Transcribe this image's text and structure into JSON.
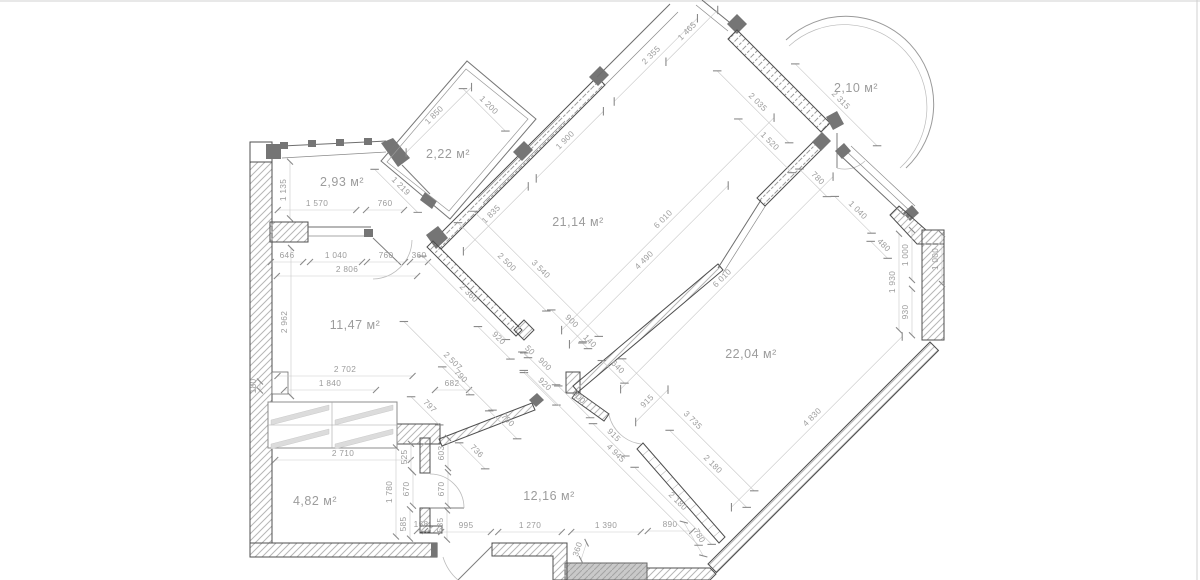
{
  "colors": {
    "background": "#ffffff",
    "wall_stroke": "#4f4f4f",
    "dark_fill": "#757575",
    "dim_text": "#9c9c9c",
    "dim_line": "#c9c9c9",
    "tick": "#8a8a8a",
    "room_text": "#9c9c9c",
    "border": "#d0d0d0"
  },
  "scale_px_per_mm": 0.05,
  "rooms": [
    {
      "label": "2,93 м²",
      "x": 342,
      "y": 186
    },
    {
      "label": "2,22 м²",
      "x": 448,
      "y": 158
    },
    {
      "label": "21,14 м²",
      "x": 578,
      "y": 226
    },
    {
      "label": "2,10 м²",
      "x": 856,
      "y": 92
    },
    {
      "label": "11,47 м²",
      "x": 355,
      "y": 329
    },
    {
      "label": "22,04 м²",
      "x": 751,
      "y": 358
    },
    {
      "label": "4,82 м²",
      "x": 315,
      "y": 505
    },
    {
      "label": "12,16 м²",
      "x": 549,
      "y": 500
    }
  ],
  "dimensions": [
    {
      "t": "1 135",
      "x": 286,
      "y": 190,
      "r": -90
    },
    {
      "t": "1 570",
      "x": 317,
      "y": 206,
      "r": 0
    },
    {
      "t": "760",
      "x": 385,
      "y": 206,
      "r": 0
    },
    {
      "t": "646",
      "x": 287,
      "y": 258,
      "r": 0
    },
    {
      "t": "1 040",
      "x": 336,
      "y": 258,
      "r": 0
    },
    {
      "t": "760",
      "x": 386,
      "y": 258,
      "r": 0
    },
    {
      "t": "360",
      "x": 419,
      "y": 258,
      "r": 0
    },
    {
      "t": "2 806",
      "x": 347,
      "y": 272,
      "r": 0
    },
    {
      "t": "2 962",
      "x": 287,
      "y": 322,
      "r": -90
    },
    {
      "t": "180",
      "x": 256,
      "y": 386,
      "r": -90
    },
    {
      "t": "2 702",
      "x": 345,
      "y": 372,
      "r": 0
    },
    {
      "t": "1 840",
      "x": 330,
      "y": 386,
      "r": 0
    },
    {
      "t": "682",
      "x": 452,
      "y": 386,
      "r": 0
    },
    {
      "t": "2 710",
      "x": 343,
      "y": 456,
      "r": 0
    },
    {
      "t": "1 780",
      "x": 392,
      "y": 492,
      "r": -90
    },
    {
      "t": "525",
      "x": 407,
      "y": 457,
      "r": -90
    },
    {
      "t": "670",
      "x": 409,
      "y": 489,
      "r": -90
    },
    {
      "t": "585",
      "x": 406,
      "y": 524,
      "r": -90
    },
    {
      "t": "603",
      "x": 444,
      "y": 453,
      "r": -90
    },
    {
      "t": "670",
      "x": 444,
      "y": 489,
      "r": -90
    },
    {
      "t": "585",
      "x": 443,
      "y": 525,
      "r": -90
    },
    {
      "t": "158",
      "x": 421,
      "y": 527,
      "r": 0
    },
    {
      "t": "995",
      "x": 466,
      "y": 528,
      "r": 0
    },
    {
      "t": "1 270",
      "x": 530,
      "y": 528,
      "r": 0
    },
    {
      "t": "1 390",
      "x": 606,
      "y": 528,
      "r": 0
    },
    {
      "t": "890",
      "x": 670,
      "y": 527,
      "r": 0
    },
    {
      "t": "360",
      "x": 580,
      "y": 550,
      "r": -72
    },
    {
      "t": "780",
      "x": 697,
      "y": 537,
      "r": 60
    },
    {
      "t": "1 850",
      "x": 436,
      "y": 117,
      "r": -45
    },
    {
      "t": "1 200",
      "x": 487,
      "y": 107,
      "r": 45
    },
    {
      "t": "1 219",
      "x": 399,
      "y": 188,
      "r": 45
    },
    {
      "t": "2 355",
      "x": 653,
      "y": 57,
      "r": -45
    },
    {
      "t": "1 465",
      "x": 689,
      "y": 33,
      "r": -45
    },
    {
      "t": "1 900",
      "x": 567,
      "y": 142,
      "r": -45
    },
    {
      "t": "1 835",
      "x": 493,
      "y": 216,
      "r": -45
    },
    {
      "t": "2 500",
      "x": 505,
      "y": 264,
      "r": 45
    },
    {
      "t": "3 540",
      "x": 539,
      "y": 271,
      "r": 45
    },
    {
      "t": "2 360",
      "x": 467,
      "y": 295,
      "r": 45
    },
    {
      "t": "4 490",
      "x": 646,
      "y": 262,
      "r": -45
    },
    {
      "t": "6 010",
      "x": 665,
      "y": 221,
      "r": -45
    },
    {
      "t": "6 010",
      "x": 724,
      "y": 280,
      "r": -45
    },
    {
      "t": "2 035",
      "x": 756,
      "y": 104,
      "r": 45
    },
    {
      "t": "1 520",
      "x": 768,
      "y": 143,
      "r": 45
    },
    {
      "t": "780",
      "x": 816,
      "y": 180,
      "r": 45
    },
    {
      "t": "2 315",
      "x": 839,
      "y": 102,
      "r": 45
    },
    {
      "t": "1 040",
      "x": 856,
      "y": 212,
      "r": 45
    },
    {
      "t": "480",
      "x": 882,
      "y": 247,
      "r": 45
    },
    {
      "t": "1 930",
      "x": 895,
      "y": 282,
      "r": -90
    },
    {
      "t": "1 000",
      "x": 908,
      "y": 255,
      "r": -90
    },
    {
      "t": "930",
      "x": 908,
      "y": 312,
      "r": -90
    },
    {
      "t": "1 000",
      "x": 938,
      "y": 259,
      "r": -90
    },
    {
      "t": "900",
      "x": 570,
      "y": 323,
      "r": 45
    },
    {
      "t": "140",
      "x": 588,
      "y": 343,
      "r": 45
    },
    {
      "t": "640",
      "x": 616,
      "y": 369,
      "r": 45
    },
    {
      "t": "900",
      "x": 543,
      "y": 366,
      "r": 45
    },
    {
      "t": "920",
      "x": 543,
      "y": 386,
      "r": 45
    },
    {
      "t": "900",
      "x": 577,
      "y": 399,
      "r": 45
    },
    {
      "t": "920",
      "x": 497,
      "y": 340,
      "r": 45
    },
    {
      "t": "50",
      "x": 528,
      "y": 352,
      "r": 45
    },
    {
      "t": "2 507",
      "x": 451,
      "y": 363,
      "r": 45
    },
    {
      "t": "790",
      "x": 459,
      "y": 378,
      "r": 45
    },
    {
      "t": "797",
      "x": 428,
      "y": 408,
      "r": 45
    },
    {
      "t": "790",
      "x": 506,
      "y": 422,
      "r": 45
    },
    {
      "t": "736",
      "x": 475,
      "y": 453,
      "r": 45
    },
    {
      "t": "915",
      "x": 649,
      "y": 403,
      "r": -45
    },
    {
      "t": "915",
      "x": 612,
      "y": 437,
      "r": 45
    },
    {
      "t": "4 945",
      "x": 614,
      "y": 455,
      "r": 45
    },
    {
      "t": "3 735",
      "x": 691,
      "y": 422,
      "r": 45
    },
    {
      "t": "2 180",
      "x": 711,
      "y": 466,
      "r": 45
    },
    {
      "t": "2 180",
      "x": 676,
      "y": 503,
      "r": 45
    },
    {
      "t": "4 830",
      "x": 814,
      "y": 419,
      "r": -45
    }
  ]
}
